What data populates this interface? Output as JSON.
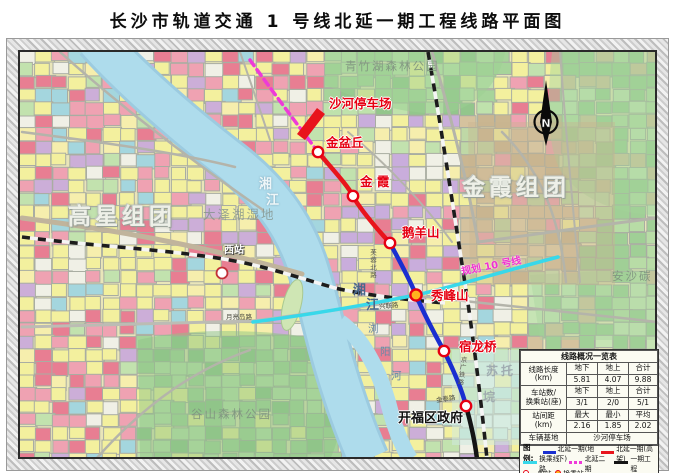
{
  "title": "长沙市轨道交通 1 号线北延一期工程线路平面图",
  "colors": {
    "line_underground": "#1a2fd0",
    "line_elevated": "#e8141c",
    "line_transfer": "#38d8ea",
    "line_phase2": "#ee3ad8",
    "line_phase1": "#141414",
    "station_ring": "#e60012",
    "station_transfer_fill": "#ffb41e"
  },
  "map": {
    "labels": {
      "qingzhuhu_park": "青竹湖森林公园",
      "shahe_depot": "沙河停车场",
      "jinpenqiu": "金盆丘",
      "jinxia_station": "金 霞",
      "eyangshan": "鹅羊山",
      "line10": "规划 10 号线",
      "xiufengshan": "秀峰山",
      "sulongqiao": "宿龙桥",
      "kaifu_government": "开福区政府",
      "gaoxing_cluster": "高星组团",
      "jinxia_cluster": "金霞组团",
      "dazehu_wetland": "大泽湖湿地",
      "xizhan": "西站",
      "yueliangdao_road": "月亮岛路",
      "xinglian_road": "兴联路",
      "furong_road": "芙蓉北路",
      "jingguang_railway": "京广铁路",
      "jintai_road": "金泰路",
      "gushan_park": "谷山森林公园",
      "sutuo_1": "苏托",
      "sutuo_2": "垸",
      "ansha": "安沙碳",
      "liuyang_river_1": "浏",
      "liuyang_river_2": "阳",
      "liuyang_river_3": "河",
      "xiangjiang_top_1": "湘",
      "xiangjiang_top_2": "江",
      "xiangjiang_low_1": "湘",
      "xiangjiang_low_2": "江",
      "north": "N"
    }
  },
  "info_table": {
    "title": "线路概况一览表",
    "length": {
      "label": "线路长度",
      "unit": "(km)",
      "c1": "地下",
      "c2": "地上",
      "c3": "合计",
      "v1": "5.81",
      "v2": "4.07",
      "v3": "9.88"
    },
    "station_count": {
      "label": "车站数/",
      "label2": "换乘站(座)",
      "c1": "地下",
      "c2": "地上",
      "c3": "合计",
      "v1": "3/1",
      "v2": "2/0",
      "v3": "5/1"
    },
    "spacing": {
      "label": "站间距",
      "unit": "(km)",
      "c1": "最大",
      "c2": "最小",
      "c3": "平均",
      "v1": "2.16",
      "v2": "1.85",
      "v3": "2.02"
    },
    "depot": {
      "label": "车辆基地",
      "value": "沙河停车场"
    },
    "legend": {
      "title": "图例:",
      "items": [
        {
          "label": "北延一期(地下)"
        },
        {
          "label": "北延一期(高架)"
        },
        {
          "label": "换乘线路"
        },
        {
          "label": "北延二期"
        },
        {
          "label": "一期工程"
        },
        {
          "label": "一般站"
        },
        {
          "label": "换乘站"
        }
      ]
    }
  }
}
